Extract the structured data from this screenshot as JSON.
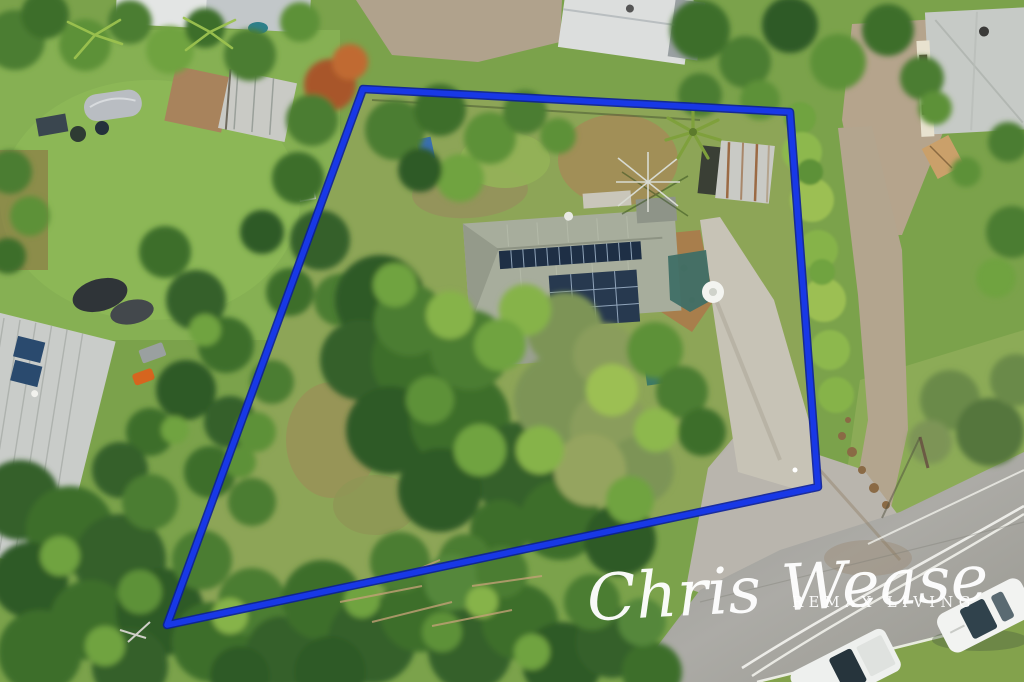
{
  "meta": {
    "image_type": "aerial-drone-photograph",
    "subject": "semi-rural residential property listing photo with marked lot boundary"
  },
  "watermark": {
    "agent_name": "Chris Wease",
    "brand": "REMAX LIVING"
  },
  "boundary": {
    "points": "363,89 790,112 818,487 167,625",
    "shape": "quadrilateral lot outline"
  },
  "palette": {
    "boundary_blue": "#1838e6",
    "boundary_dark": "#0a1e9a",
    "watermark_white": "#ffffff",
    "grass_base": "#7ba24b",
    "lawn_bright": "#86b053",
    "yard_olive": "#8da557",
    "tree_dark": "#2f5a26",
    "tree_mid": "#4b7d31",
    "tree_light": "#6fa33f",
    "casuarina_olive": "#7d9457",
    "road_asphalt": "#a5a4a0",
    "gravel_track": "#b3a58e",
    "concrete": "#c7c3b6",
    "mulch_brown": "#a87e4c",
    "house_roof": "#a7ad9c",
    "solar_panel": "#1e2f45",
    "shed_silver": "#c9cac5",
    "shed_rust": "#9b6a44"
  },
  "scene": {
    "landmarks": [
      {
        "name": "property-boundary",
        "note": "blue outlined lot"
      },
      {
        "name": "main-house",
        "note": "grey metal roof with two solar arrays"
      },
      {
        "name": "garden-shed",
        "note": "silver/rust roof, top right of lot"
      },
      {
        "name": "rotary-clothesline",
        "note": "in rear yard"
      },
      {
        "name": "concrete-driveway",
        "note": "runs to road at lot corner"
      },
      {
        "name": "sealed-road",
        "note": "bottom right, double white centreline"
      },
      {
        "name": "parked-cars",
        "note": "two white vehicles on grass verge"
      },
      {
        "name": "gravel-track",
        "note": "along right side of lot"
      },
      {
        "name": "neighbour-shed-north",
        "note": "tan and silver roof"
      },
      {
        "name": "covered-car",
        "note": "grey car cover, north lawn"
      },
      {
        "name": "neighbour-roof-west",
        "note": "silver roof with solar panels"
      },
      {
        "name": "two-storey-house-northeast",
        "note": "grey hip roof"
      }
    ]
  }
}
